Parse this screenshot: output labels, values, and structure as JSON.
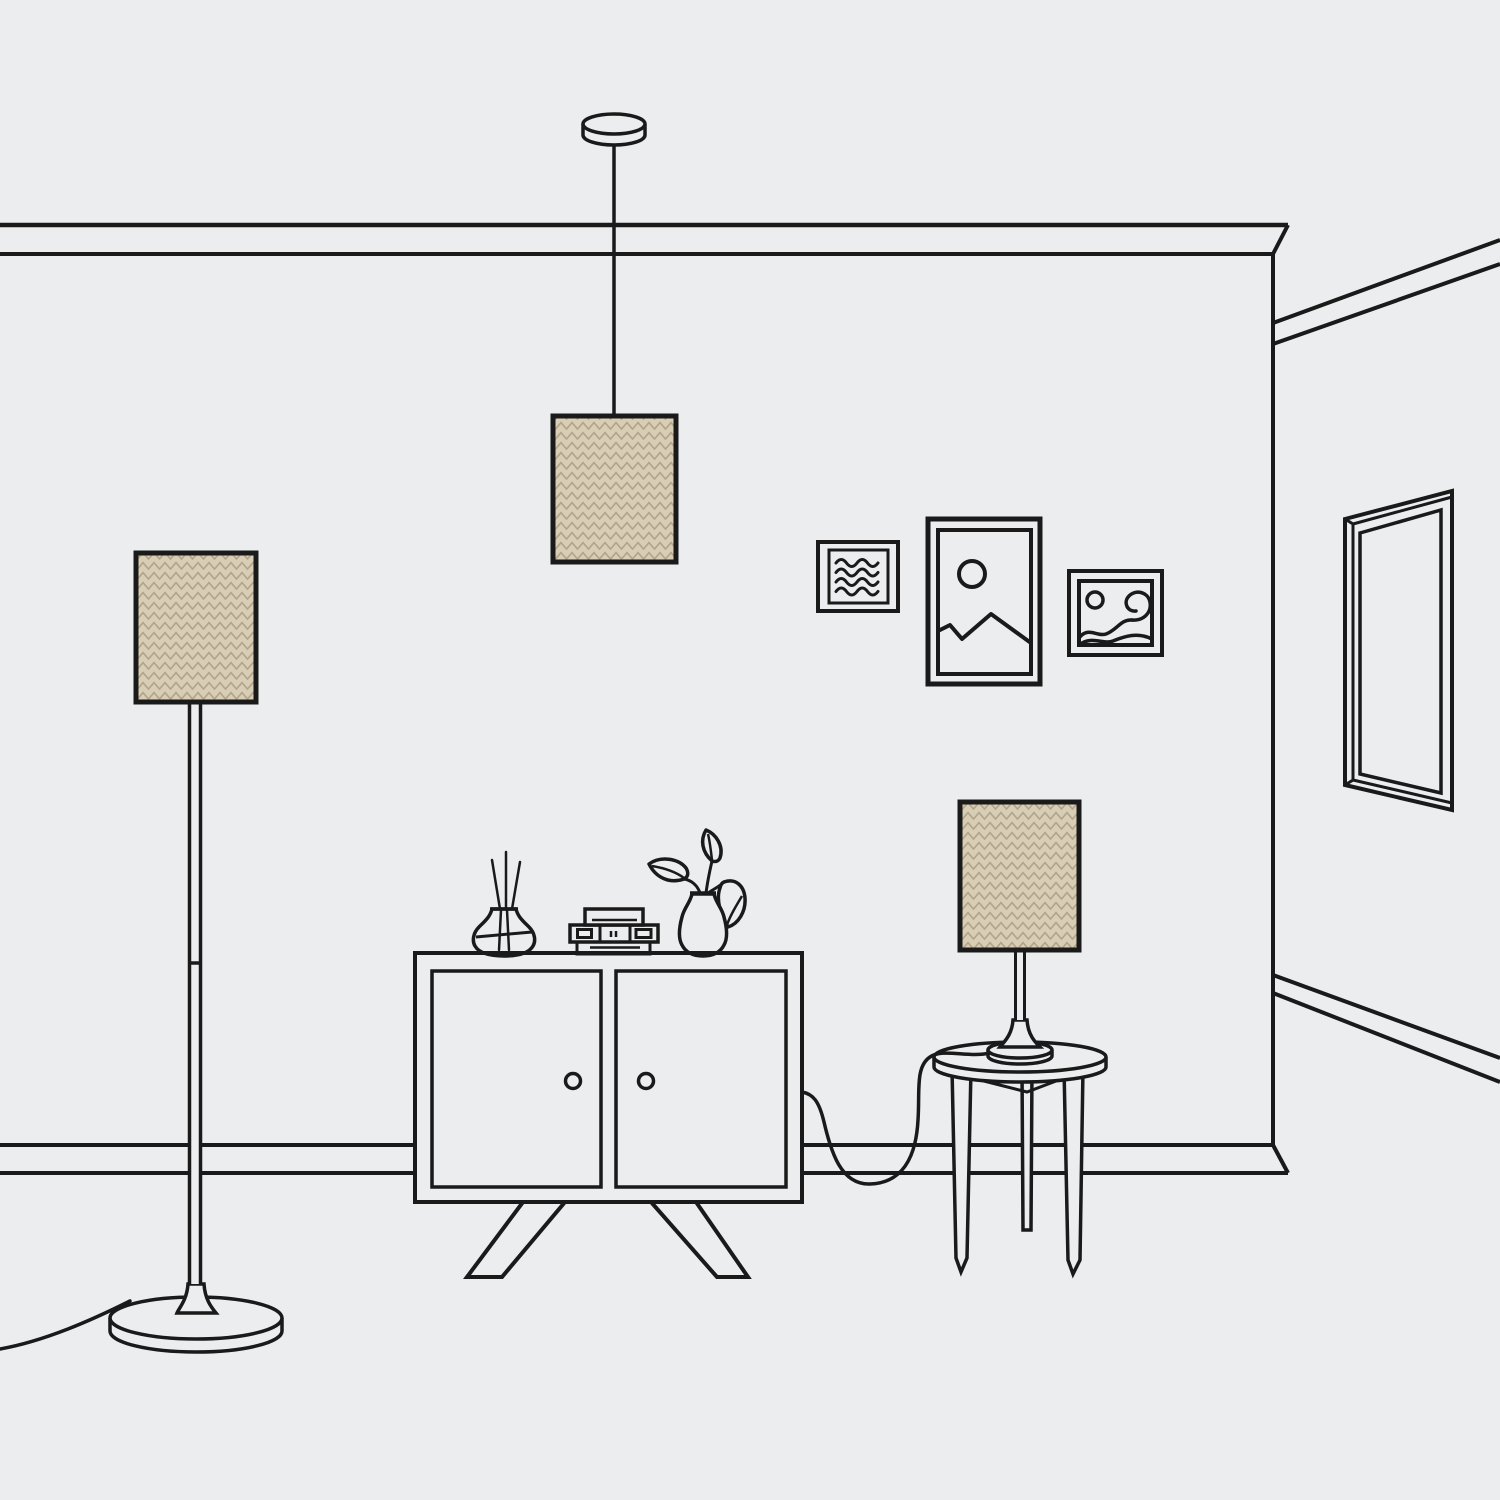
{
  "scene": {
    "label": "Line-art illustration of a living room: floor lamp, pendant lamp and table lamp with tan herringbone shades, a two-door cabinet with reed diffuser, radio and plant vase, a round side table, three wall frames and a wall mirror",
    "objects": [
      "crown-molding",
      "baseboard",
      "wall-corner",
      "pendant-lamp",
      "floor-lamp",
      "table-lamp",
      "cabinet",
      "side-table",
      "reed-diffuser",
      "radio",
      "plant-vase",
      "frame-waves",
      "frame-mountain",
      "frame-abstract-wave",
      "wall-mirror",
      "floor-lamp-cord",
      "table-lamp-cord"
    ]
  },
  "colors": {
    "background": "#ECEDEE",
    "line": "#1A1A1A",
    "shade_fill": "#D8CDB5",
    "shade_pattern": "#B1A48A"
  }
}
